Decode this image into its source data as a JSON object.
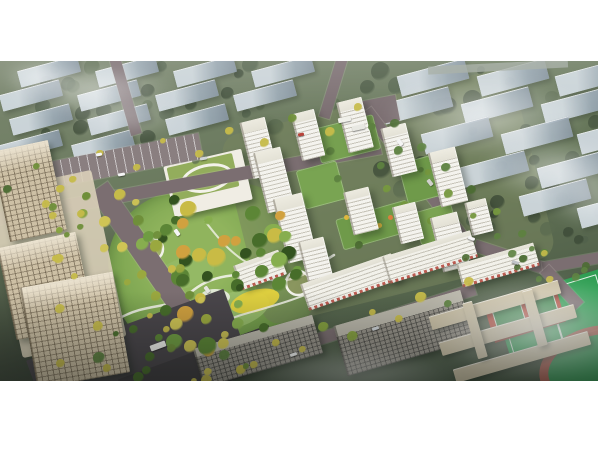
{
  "image": {
    "alt": "Aerial bird's-eye architectural rendering of a residential development: white high-rise apartment towers arranged around landscaped courtyards, a large central park with winding white paths and a yellow playground, a kindergarten with a green roof running loop, tree-lined avenues with yellow-foliage trees, beige office towers on the left, grey mid-rise blocks along the south road, a school campus with red basketball courts and a green sports field with running track at lower right, hazy rows of blue-grey city blocks in the background and drifting white fog",
    "type_label": "architectural-rendering"
  },
  "landmarks": {
    "background_city": "rows of blue-grey slab buildings in greenery",
    "residential_towers": "white apartment high-rises with balcony stripes",
    "retail_slabs": "mid-rise slabs with ground-floor shops",
    "central_park": "community park with winding paths",
    "playground": "yellow play area",
    "kindergarten": "green-roof kindergarten with rooftop loop",
    "offices_west": "beige office towers and plaza",
    "grey_midrises": "grey residential mid-rises",
    "school_campus": "beige school buildings",
    "sports_field": "green pitch with white markings",
    "basketball_courts": "red courts with green play boxes",
    "running_track": "red-brown oval track",
    "roads": "grey urban roads with cars and buses",
    "fog": "white cloud wisps"
  },
  "palette": {
    "canvas_bg": "#ffffff",
    "landscape_green": "#61724f",
    "background_building": "#9aa9b5",
    "road_grey": "#7b6e71",
    "tower_white": "#f2f1ec",
    "park_green": "#7aa34f",
    "accent_yellow": "#e4d23e",
    "office_beige": "#cdc0a5",
    "field_green": "#2f9e53",
    "court_red": "#b54a3c",
    "track_red": "#aa5a4e",
    "fog_white": "#ffffff"
  }
}
